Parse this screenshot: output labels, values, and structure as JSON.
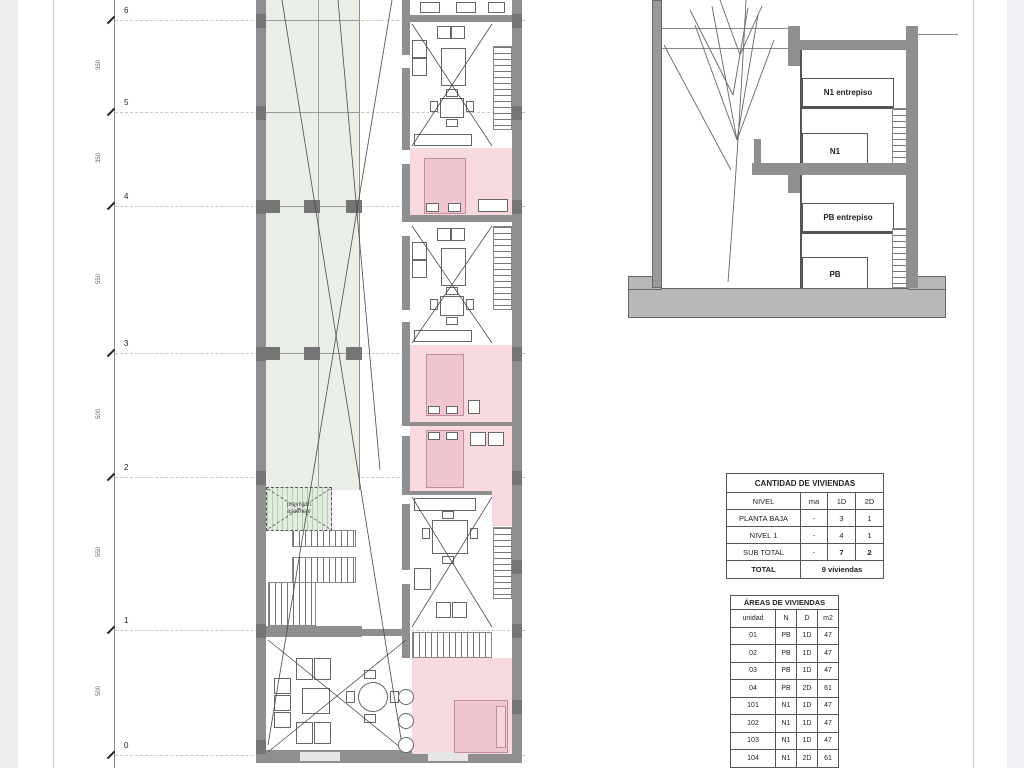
{
  "grid": {
    "axis_labels": [
      "6",
      "5",
      "4",
      "3",
      "2",
      "1",
      "0"
    ],
    "segment_dims": [
      "350",
      "350",
      "550",
      "500",
      "550",
      "500"
    ]
  },
  "plan": {
    "elevator_line1": "previsión",
    "elevator_line2": "ascensor"
  },
  "section": {
    "labels": {
      "n1e": "N1 entrepiso",
      "n1": "N1",
      "pbe": "PB entrepiso",
      "pb": "PB"
    }
  },
  "tables": {
    "cantidad": {
      "title": "CANTIDAD DE VIVIENDAS",
      "headers": [
        "NIVEL",
        "ma",
        "1D",
        "2D"
      ],
      "rows": [
        [
          "PLANTA BAJA",
          "-",
          "3",
          "1"
        ],
        [
          "NIVEL 1",
          "-",
          "4",
          "1"
        ],
        [
          "SUB TOTAL",
          "-",
          "7",
          "2"
        ]
      ],
      "total_label": "TOTAL",
      "total_value": "9 viviendas"
    },
    "areas": {
      "title": "ÁREAS DE VIVIENDAS",
      "headers": [
        "unidad",
        "N",
        "D",
        "m2"
      ],
      "rows": [
        [
          "01",
          "PB",
          "1D",
          "47"
        ],
        [
          "02",
          "PB",
          "1D",
          "47"
        ],
        [
          "03",
          "PB",
          "1D",
          "47"
        ],
        [
          "04",
          "PB",
          "2D",
          "61"
        ],
        [
          "101",
          "N1",
          "1D",
          "47"
        ],
        [
          "102",
          "N1",
          "1D",
          "47"
        ],
        [
          "103",
          "N1",
          "1D",
          "47"
        ],
        [
          "104",
          "N1",
          "2D",
          "61"
        ]
      ]
    }
  },
  "colors": {
    "wall_gray": "#8f8f8f",
    "courtyard_green": "#e9efe6",
    "bedroom_pink": "#f7d9de",
    "ground_gray": "#b8b8b8"
  }
}
